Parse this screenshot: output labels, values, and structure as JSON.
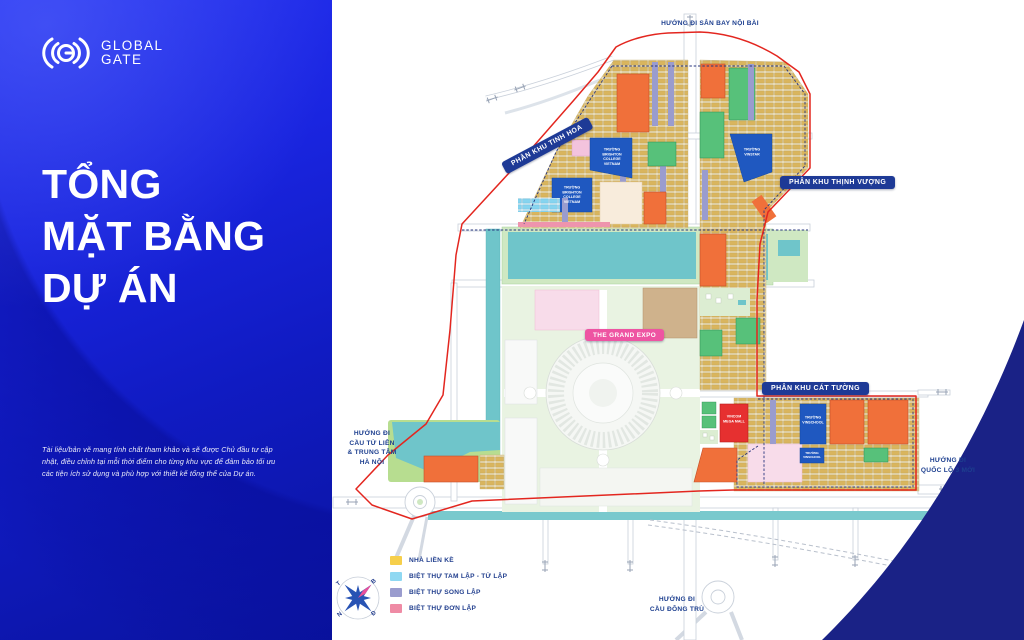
{
  "brand": {
    "line1": "GLOBAL",
    "line2": "GATE"
  },
  "title": {
    "l1": "TỔNG",
    "l2": "MẶT BẰNG",
    "l3": "DỰ ÁN"
  },
  "disclaimer": "Tài liệu/bản vẽ mang tính chất tham khảo và sẽ được Chủ đầu tư cập nhật, điều chỉnh tại mỗi thời điểm cho từng khu vực để đảm bảo tối ưu các tiện ích sử dụng và phù hợp với thiết kế tổng thể của Dự án.",
  "directions": {
    "north": "HƯỚNG ĐI SÂN BAY NỘI BÀI",
    "west": {
      "l1": "HƯỚNG ĐI",
      "l2": "CẦU TỨ LIÊN",
      "l3": "& TRUNG TÂM",
      "l4": "HÀ NỘI"
    },
    "east": {
      "l1": "HƯỚNG ĐI",
      "l2": "QUỐC LỘ 3 MỚI"
    },
    "south": {
      "l1": "HƯỚNG ĐI",
      "l2": "CẦU ĐÔNG TRÙ"
    }
  },
  "zones": {
    "tinh_hoa": "PHÂN KHU TINH HOA",
    "thinh_vuong": "PHÂN KHU THỊNH VƯỢNG",
    "cat_tuong": "PHÂN KHU CÁT TƯỜNG",
    "grand_expo": "THE GRAND EXPO"
  },
  "places": {
    "brighton": "TRƯỜNG BRIGHTON COLLEGE VIETNAM",
    "vinschool": "TRƯỜNG VINSCHOOL",
    "vinstar": "TRƯỜNG VINSTAR",
    "vincom": "VINCOM MEGA MALL"
  },
  "legend": {
    "items": [
      {
        "label": "NHÀ LIỀN KỀ",
        "color": "#f6cf4b"
      },
      {
        "label": "BIỆT THỰ TAM LẬP - TỨ LẬP",
        "color": "#8fd8f2"
      },
      {
        "label": "BIỆT THỰ SONG LẬP",
        "color": "#9a9cce"
      },
      {
        "label": "BIỆT THỰ ĐƠN LẬP",
        "color": "#ef8ba5"
      }
    ]
  },
  "compass": {
    "n": "B",
    "w": "T",
    "s": "N",
    "e": "Đ"
  },
  "colors": {
    "panel_blue": "#1522d6",
    "boundary_red": "#e3261f",
    "water_teal": "#6fc5ca",
    "navy": "#1e3a96",
    "expo_pink": "#ee54a2",
    "school_blue": "#1f58c0",
    "block_orange": "#f0703a",
    "park_green": "#57c17a",
    "mall_red": "#e63030"
  }
}
